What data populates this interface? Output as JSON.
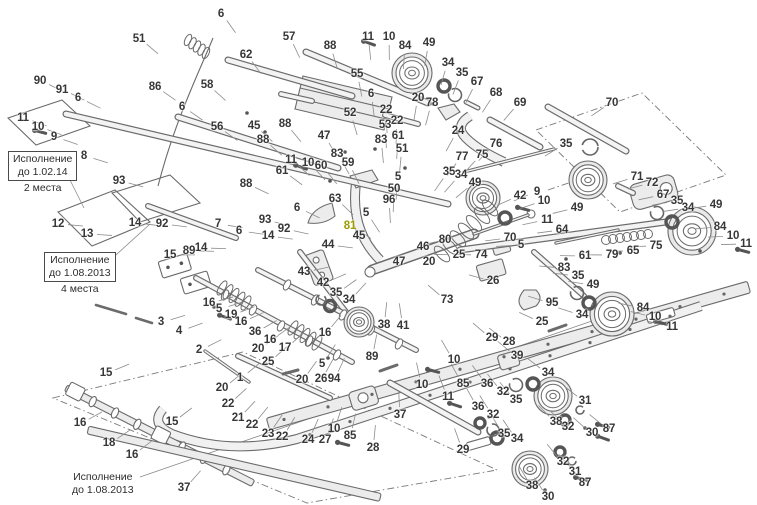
{
  "diagram": {
    "type": "exploded-parts-diagram",
    "colors": {
      "background": "#ffffff",
      "line": "#6b6b6b",
      "label": "#373737",
      "highlight": "#9c9c00"
    },
    "notes": [
      {
        "line1": "Исполнение",
        "line2": "до 1.02.14",
        "footer": "2 места"
      },
      {
        "line1": "Исполнение",
        "line2": "до 1.08.2013",
        "footer": "4 места"
      },
      {
        "line1": "Исполнение",
        "line2": "до 1.08.2013"
      }
    ],
    "labels": [
      {
        "n": "51",
        "x": 139,
        "y": 39
      },
      {
        "n": "6",
        "x": 221,
        "y": 14
      },
      {
        "n": "86",
        "x": 155,
        "y": 87
      },
      {
        "n": "58",
        "x": 207,
        "y": 85
      },
      {
        "n": "62",
        "x": 246,
        "y": 55
      },
      {
        "n": "90",
        "x": 40,
        "y": 81
      },
      {
        "n": "91",
        "x": 62,
        "y": 90
      },
      {
        "n": "6",
        "x": 78,
        "y": 98
      },
      {
        "n": "11",
        "x": 23,
        "y": 118
      },
      {
        "n": "10",
        "x": 38,
        "y": 127
      },
      {
        "n": "9",
        "x": 54,
        "y": 137
      },
      {
        "n": "8",
        "x": 84,
        "y": 156
      },
      {
        "n": "6",
        "x": 182,
        "y": 107
      },
      {
        "n": "56",
        "x": 217,
        "y": 127
      },
      {
        "n": "57",
        "x": 289,
        "y": 37
      },
      {
        "n": "88",
        "x": 330,
        "y": 46
      },
      {
        "n": "11",
        "x": 368,
        "y": 37
      },
      {
        "n": "10",
        "x": 389,
        "y": 37
      },
      {
        "n": "84",
        "x": 405,
        "y": 46
      },
      {
        "n": "49",
        "x": 429,
        "y": 43
      },
      {
        "n": "34",
        "x": 448,
        "y": 63
      },
      {
        "n": "35",
        "x": 462,
        "y": 73
      },
      {
        "n": "67",
        "x": 477,
        "y": 82
      },
      {
        "n": "68",
        "x": 496,
        "y": 93
      },
      {
        "n": "69",
        "x": 520,
        "y": 103
      },
      {
        "n": "70",
        "x": 612,
        "y": 103
      },
      {
        "n": "55",
        "x": 357,
        "y": 74
      },
      {
        "n": "6",
        "x": 371,
        "y": 94
      },
      {
        "n": "52",
        "x": 350,
        "y": 113
      },
      {
        "n": "22",
        "x": 386,
        "y": 110
      },
      {
        "n": "22",
        "x": 397,
        "y": 121
      },
      {
        "n": "53",
        "x": 385,
        "y": 125
      },
      {
        "n": "83",
        "x": 381,
        "y": 140
      },
      {
        "n": "61",
        "x": 398,
        "y": 136
      },
      {
        "n": "20",
        "x": 418,
        "y": 98
      },
      {
        "n": "78",
        "x": 432,
        "y": 103
      },
      {
        "n": "24",
        "x": 458,
        "y": 131
      },
      {
        "n": "76",
        "x": 496,
        "y": 144
      },
      {
        "n": "75",
        "x": 482,
        "y": 155
      },
      {
        "n": "77",
        "x": 462,
        "y": 157
      },
      {
        "n": "51",
        "x": 402,
        "y": 149
      },
      {
        "n": "45",
        "x": 254,
        "y": 126
      },
      {
        "n": "88",
        "x": 285,
        "y": 124
      },
      {
        "n": "47",
        "x": 324,
        "y": 136
      },
      {
        "n": "88",
        "x": 263,
        "y": 140
      },
      {
        "n": "11",
        "x": 291,
        "y": 160
      },
      {
        "n": "10",
        "x": 308,
        "y": 163
      },
      {
        "n": "60",
        "x": 321,
        "y": 166
      },
      {
        "n": "83",
        "x": 337,
        "y": 154
      },
      {
        "n": "59",
        "x": 348,
        "y": 163
      },
      {
        "n": "35",
        "x": 566,
        "y": 144
      },
      {
        "n": "93",
        "x": 119,
        "y": 181
      },
      {
        "n": "88",
        "x": 246,
        "y": 184
      },
      {
        "n": "7",
        "x": 218,
        "y": 224
      },
      {
        "n": "6",
        "x": 239,
        "y": 231
      },
      {
        "n": "12",
        "x": 58,
        "y": 224
      },
      {
        "n": "14",
        "x": 135,
        "y": 223
      },
      {
        "n": "92",
        "x": 162,
        "y": 224
      },
      {
        "n": "13",
        "x": 87,
        "y": 234
      },
      {
        "n": "14",
        "x": 201,
        "y": 248
      },
      {
        "n": "15",
        "x": 170,
        "y": 255
      },
      {
        "n": "89",
        "x": 189,
        "y": 251
      },
      {
        "n": "93",
        "x": 265,
        "y": 220
      },
      {
        "n": "92",
        "x": 284,
        "y": 229
      },
      {
        "n": "14",
        "x": 268,
        "y": 236
      },
      {
        "n": "6",
        "x": 297,
        "y": 208
      },
      {
        "n": "16",
        "x": 209,
        "y": 303
      },
      {
        "n": "5",
        "x": 219,
        "y": 309
      },
      {
        "n": "19",
        "x": 231,
        "y": 315
      },
      {
        "n": "16",
        "x": 241,
        "y": 322
      },
      {
        "n": "36",
        "x": 255,
        "y": 332
      },
      {
        "n": "16",
        "x": 270,
        "y": 340
      },
      {
        "n": "16",
        "x": 325,
        "y": 333
      },
      {
        "n": "17",
        "x": 285,
        "y": 348
      },
      {
        "n": "3",
        "x": 161,
        "y": 322
      },
      {
        "n": "4",
        "x": 179,
        "y": 331
      },
      {
        "n": "2",
        "x": 199,
        "y": 350
      },
      {
        "n": "61",
        "x": 282,
        "y": 171
      },
      {
        "n": "63",
        "x": 335,
        "y": 199
      },
      {
        "n": "81",
        "x": 350,
        "y": 226,
        "c": "hl"
      },
      {
        "n": "5",
        "x": 398,
        "y": 177
      },
      {
        "n": "50",
        "x": 394,
        "y": 189
      },
      {
        "n": "96",
        "x": 389,
        "y": 200
      },
      {
        "n": "5",
        "x": 366,
        "y": 213
      },
      {
        "n": "45",
        "x": 359,
        "y": 236
      },
      {
        "n": "44",
        "x": 328,
        "y": 245
      },
      {
        "n": "43",
        "x": 304,
        "y": 272
      },
      {
        "n": "42",
        "x": 323,
        "y": 283
      },
      {
        "n": "35",
        "x": 336,
        "y": 293
      },
      {
        "n": "34",
        "x": 349,
        "y": 300
      },
      {
        "n": "46",
        "x": 423,
        "y": 247
      },
      {
        "n": "47",
        "x": 399,
        "y": 262
      },
      {
        "n": "20",
        "x": 429,
        "y": 262
      },
      {
        "n": "25",
        "x": 459,
        "y": 255
      },
      {
        "n": "74",
        "x": 481,
        "y": 255
      },
      {
        "n": "26",
        "x": 493,
        "y": 281
      },
      {
        "n": "80",
        "x": 445,
        "y": 240
      },
      {
        "n": "73",
        "x": 447,
        "y": 300
      },
      {
        "n": "38",
        "x": 384,
        "y": 325
      },
      {
        "n": "41",
        "x": 403,
        "y": 326
      },
      {
        "n": "35",
        "x": 449,
        "y": 172
      },
      {
        "n": "34",
        "x": 461,
        "y": 175
      },
      {
        "n": "49",
        "x": 475,
        "y": 183
      },
      {
        "n": "42",
        "x": 520,
        "y": 196
      },
      {
        "n": "9",
        "x": 537,
        "y": 192
      },
      {
        "n": "10",
        "x": 544,
        "y": 201
      },
      {
        "n": "11",
        "x": 547,
        "y": 220
      },
      {
        "n": "70",
        "x": 510,
        "y": 238
      },
      {
        "n": "5",
        "x": 521,
        "y": 245
      },
      {
        "n": "64",
        "x": 562,
        "y": 230
      },
      {
        "n": "61",
        "x": 585,
        "y": 256
      },
      {
        "n": "83",
        "x": 564,
        "y": 268
      },
      {
        "n": "95",
        "x": 552,
        "y": 303
      },
      {
        "n": "25",
        "x": 542,
        "y": 322
      },
      {
        "n": "35",
        "x": 578,
        "y": 276
      },
      {
        "n": "49",
        "x": 593,
        "y": 285
      },
      {
        "n": "34",
        "x": 582,
        "y": 315
      },
      {
        "n": "49",
        "x": 577,
        "y": 208
      },
      {
        "n": "71",
        "x": 637,
        "y": 177
      },
      {
        "n": "72",
        "x": 652,
        "y": 183
      },
      {
        "n": "67",
        "x": 663,
        "y": 195
      },
      {
        "n": "35",
        "x": 677,
        "y": 201
      },
      {
        "n": "34",
        "x": 688,
        "y": 208
      },
      {
        "n": "49",
        "x": 716,
        "y": 205
      },
      {
        "n": "84",
        "x": 720,
        "y": 227
      },
      {
        "n": "10",
        "x": 733,
        "y": 236
      },
      {
        "n": "11",
        "x": 746,
        "y": 244
      },
      {
        "n": "79",
        "x": 612,
        "y": 255
      },
      {
        "n": "65",
        "x": 633,
        "y": 251
      },
      {
        "n": "75",
        "x": 656,
        "y": 246
      },
      {
        "n": "84",
        "x": 643,
        "y": 308
      },
      {
        "n": "10",
        "x": 655,
        "y": 317
      },
      {
        "n": "11",
        "x": 672,
        "y": 327
      },
      {
        "n": "15",
        "x": 106,
        "y": 373
      },
      {
        "n": "16",
        "x": 80,
        "y": 423
      },
      {
        "n": "18",
        "x": 109,
        "y": 443
      },
      {
        "n": "16",
        "x": 132,
        "y": 455
      },
      {
        "n": "15",
        "x": 172,
        "y": 422
      },
      {
        "n": "37",
        "x": 184,
        "y": 488
      },
      {
        "n": "1",
        "x": 240,
        "y": 378
      },
      {
        "n": "20",
        "x": 222,
        "y": 388
      },
      {
        "n": "22",
        "x": 228,
        "y": 404
      },
      {
        "n": "21",
        "x": 238,
        "y": 418
      },
      {
        "n": "22",
        "x": 252,
        "y": 425
      },
      {
        "n": "25",
        "x": 268,
        "y": 362
      },
      {
        "n": "20",
        "x": 302,
        "y": 380
      },
      {
        "n": "20",
        "x": 258,
        "y": 349
      },
      {
        "n": "23",
        "x": 268,
        "y": 434
      },
      {
        "n": "22",
        "x": 282,
        "y": 437
      },
      {
        "n": "24",
        "x": 308,
        "y": 440
      },
      {
        "n": "27",
        "x": 325,
        "y": 440
      },
      {
        "n": "10",
        "x": 334,
        "y": 429
      },
      {
        "n": "85",
        "x": 350,
        "y": 436
      },
      {
        "n": "28",
        "x": 373,
        "y": 448
      },
      {
        "n": "26",
        "x": 321,
        "y": 379
      },
      {
        "n": "94",
        "x": 334,
        "y": 379
      },
      {
        "n": "5",
        "x": 322,
        "y": 364
      },
      {
        "n": "89",
        "x": 372,
        "y": 357
      },
      {
        "n": "37",
        "x": 400,
        "y": 415
      },
      {
        "n": "10",
        "x": 454,
        "y": 360
      },
      {
        "n": "85",
        "x": 463,
        "y": 384
      },
      {
        "n": "11",
        "x": 448,
        "y": 397
      },
      {
        "n": "10",
        "x": 422,
        "y": 385
      },
      {
        "n": "29",
        "x": 492,
        "y": 338
      },
      {
        "n": "28",
        "x": 509,
        "y": 342
      },
      {
        "n": "39",
        "x": 517,
        "y": 356
      },
      {
        "n": "36",
        "x": 487,
        "y": 384
      },
      {
        "n": "36",
        "x": 478,
        "y": 407
      },
      {
        "n": "32",
        "x": 493,
        "y": 415
      },
      {
        "n": "29",
        "x": 463,
        "y": 450
      },
      {
        "n": "34",
        "x": 548,
        "y": 373
      },
      {
        "n": "35",
        "x": 516,
        "y": 400
      },
      {
        "n": "32",
        "x": 503,
        "y": 392
      },
      {
        "n": "38",
        "x": 556,
        "y": 422
      },
      {
        "n": "32",
        "x": 568,
        "y": 427
      },
      {
        "n": "31",
        "x": 585,
        "y": 401
      },
      {
        "n": "30",
        "x": 592,
        "y": 433
      },
      {
        "n": "87",
        "x": 609,
        "y": 429
      },
      {
        "n": "35",
        "x": 504,
        "y": 434
      },
      {
        "n": "34",
        "x": 517,
        "y": 439
      },
      {
        "n": "38",
        "x": 532,
        "y": 486
      },
      {
        "n": "32",
        "x": 563,
        "y": 462
      },
      {
        "n": "31",
        "x": 575,
        "y": 472
      },
      {
        "n": "87",
        "x": 585,
        "y": 483
      },
      {
        "n": "30",
        "x": 548,
        "y": 497
      }
    ]
  }
}
